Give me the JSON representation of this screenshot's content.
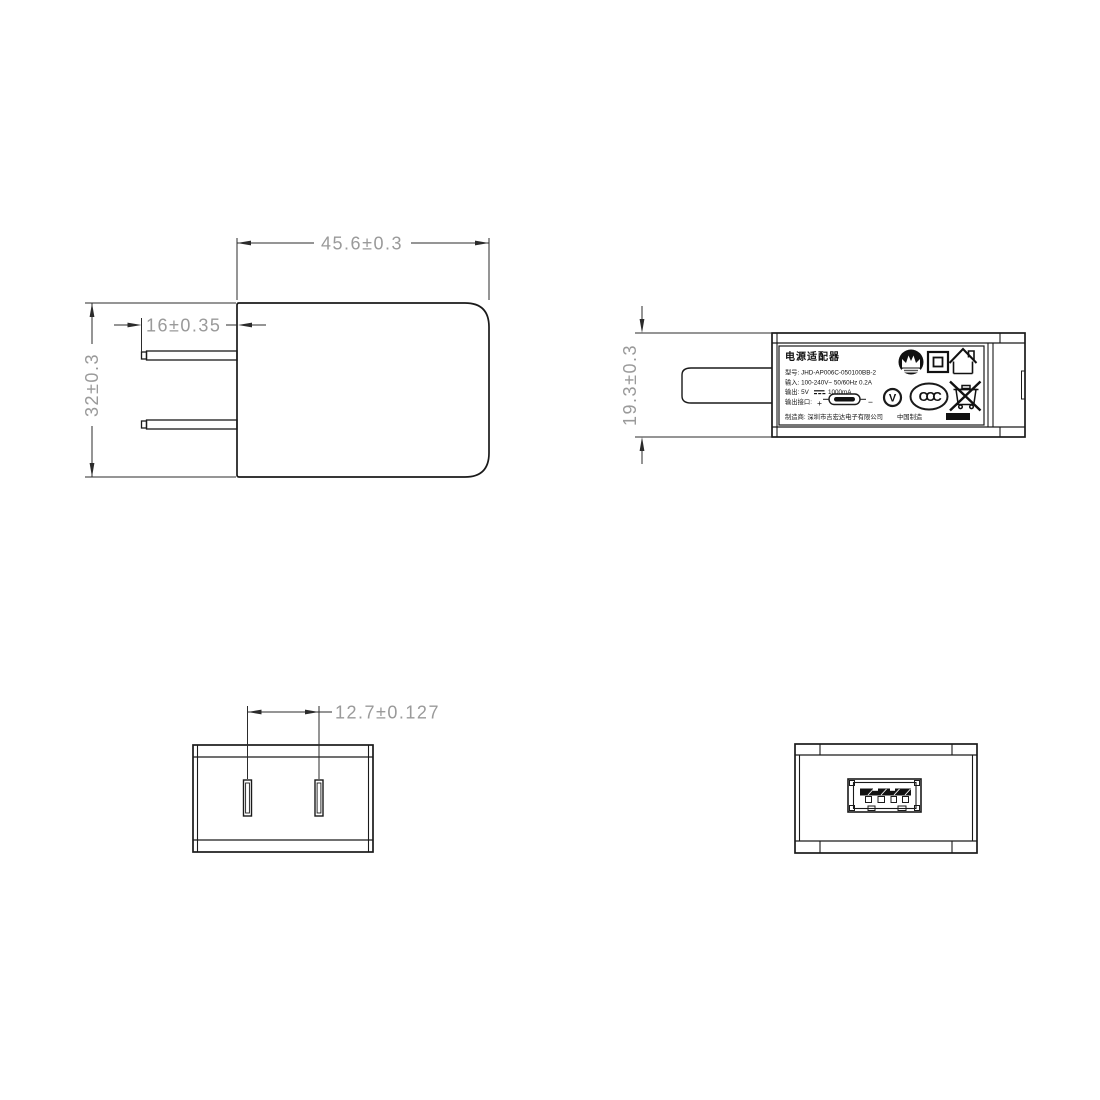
{
  "page": {
    "type": "technical-drawing",
    "subject": "usb-power-adapter",
    "background": "#ffffff"
  },
  "colors": {
    "line": "#1a1a1a",
    "dim_line": "#2b2b2b",
    "dim_text": "#9a9a9a",
    "label_text": "#111111"
  },
  "front_view": {
    "dim_width": "45.6±0.3",
    "dim_prong_length": "16±0.35",
    "dim_height": "32±0.3"
  },
  "side_view": {
    "dim_thickness": "19.3±0.3",
    "label": {
      "title": "电源适配器",
      "model": "型号: JHD-AP006C-050100BB-2",
      "input": "输入: 100-240V~  50/60Hz  0.2A",
      "output_prefix": "输出: 5V",
      "output_suffix": "1000mA",
      "interface": "输出接口:",
      "plus": "+",
      "minus": "−",
      "manufacturer": "制造商: 深圳市吉宏达电子有限公司",
      "made_in": "中国制造",
      "efficiency_mark": "V",
      "ccc_mark": "CCC",
      "icons": [
        "brand-logo-icon",
        "class-ii-icon",
        "indoor-use-icon",
        "efficiency-v-icon",
        "ccc-icon",
        "weee-bin-icon",
        "usb-plug-icon"
      ]
    }
  },
  "top_view": {
    "dim_pin_spacing": "12.7±0.127"
  },
  "end_view": {
    "port": "usb-a-receptacle"
  }
}
